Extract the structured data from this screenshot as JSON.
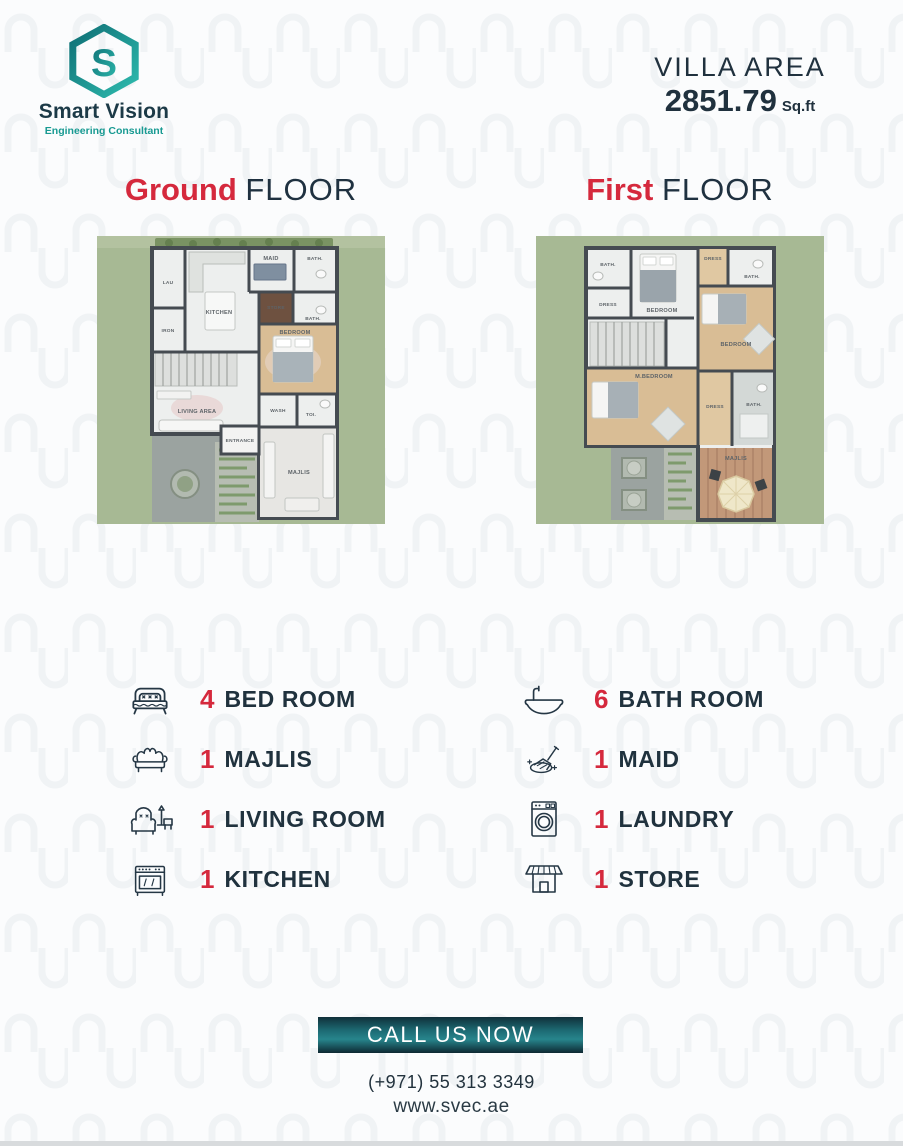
{
  "brand": {
    "name": "Smart Vision",
    "tagline": "Engineering Consultant",
    "initial": "S"
  },
  "villa_area": {
    "label": "VILLA AREA",
    "value": "2851.79",
    "unit": "Sq.ft"
  },
  "floors": {
    "ground": {
      "title_accent": "Ground",
      "title_rest": "FLOOR",
      "rooms": [
        "LAU",
        "IRON",
        "KITCHEN",
        "MAID",
        "BATH.",
        "STORE",
        "BATH.",
        "BEDROOM",
        "LIVING AREA",
        "ENTRANCE",
        "WASH",
        "TOI.",
        "MAJLIS"
      ]
    },
    "first": {
      "title_accent": "First",
      "title_rest": "FLOOR",
      "rooms": [
        "BATH.",
        "DRESS",
        "BEDROOM",
        "DRESS",
        "BATH.",
        "BEDROOM",
        "M.BEDROOM",
        "DRESS",
        "BATH.",
        "MAJLIS"
      ]
    }
  },
  "amenities": {
    "left": [
      {
        "count": "4",
        "label": "BED ROOM",
        "icon": "bed-icon"
      },
      {
        "count": "1",
        "label": "MAJLIS",
        "icon": "sofa-icon"
      },
      {
        "count": "1",
        "label": "LIVING ROOM",
        "icon": "armchair-icon"
      },
      {
        "count": "1",
        "label": "KITCHEN",
        "icon": "stove-icon"
      }
    ],
    "right": [
      {
        "count": "6",
        "label": "BATH ROOM",
        "icon": "bathtub-icon"
      },
      {
        "count": "1",
        "label": "MAID",
        "icon": "cleaning-icon"
      },
      {
        "count": "1",
        "label": "LAUNDRY",
        "icon": "washing-machine-icon"
      },
      {
        "count": "1",
        "label": "STORE",
        "icon": "storefront-icon"
      }
    ]
  },
  "cta": {
    "button": "CALL US NOW",
    "phone": "(+971) 55 313 3349",
    "website": "www.svec.ae"
  },
  "colors": {
    "accent_red": "#d5293d",
    "navy": "#20323e",
    "teal": "#189a92",
    "plan_green": "#a7b994",
    "button_gradient_dark": "#10303a",
    "button_gradient_mid": "#27858c"
  }
}
